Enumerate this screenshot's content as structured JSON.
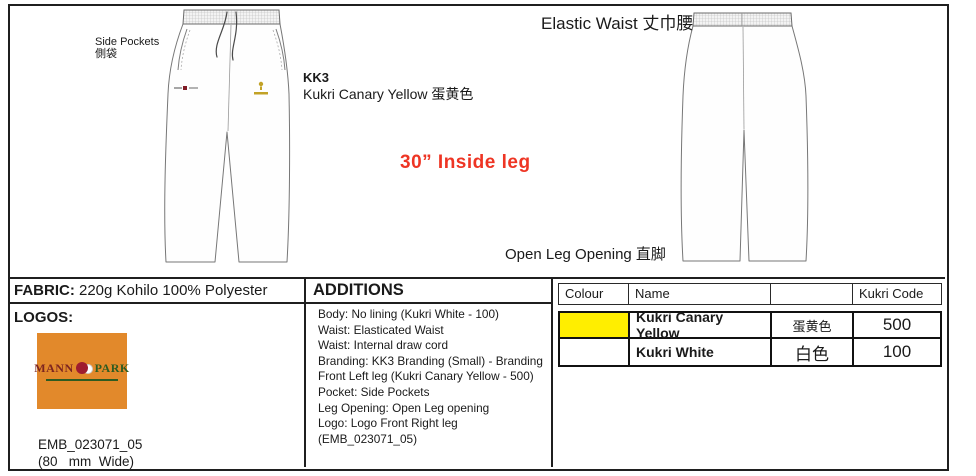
{
  "sheet": {
    "drawing_labels": {
      "side_pockets_en": "Side Pockets",
      "side_pockets_cn": "側袋",
      "branding_code": "KK3",
      "branding_name": "Kukri Canary Yellow 蛋黄色",
      "elastic_waist": "Elastic Waist 丈巾腰",
      "inside_leg": "30” Inside leg",
      "open_leg": "Open Leg Opening 直脚"
    },
    "fabric": {
      "label": "FABRIC:",
      "value": "220g Kohilo 100% Polyester"
    },
    "logos": {
      "title": "LOGOS:",
      "logo_text_left": "MANN",
      "logo_text_right": "PARK",
      "emb_code": "EMB_023071_05",
      "width_note": "(80   mm  Wide)"
    },
    "additions": {
      "title": "ADDITIONS",
      "text": "Body: No lining (Kukri White - 100)\nWaist: Elasticated Waist\nWaist: Internal draw cord\nBranding: KK3 Branding (Small) - Branding\nFront Left leg (Kukri Canary Yellow - 500)\nPocket: Side Pockets\nLeg Opening: Open Leg opening\nLogo: Logo Front Right leg\n(EMB_023071_05)"
    },
    "colour_table": {
      "headers": [
        "Colour",
        "Name",
        "",
        "Kukri Code"
      ],
      "rows": [
        {
          "swatch": "#FFEE00",
          "name": "Kukri Canary Yellow",
          "cn": "蛋黄色",
          "code": "500"
        },
        {
          "swatch": "#FFFFFF",
          "name": "Kukri White",
          "cn": "白色",
          "code": "100"
        }
      ]
    },
    "colors": {
      "accent_red": "#EE3524",
      "swatch_yellow": "#FFEE00",
      "logo_orange": "#E2892B"
    }
  }
}
